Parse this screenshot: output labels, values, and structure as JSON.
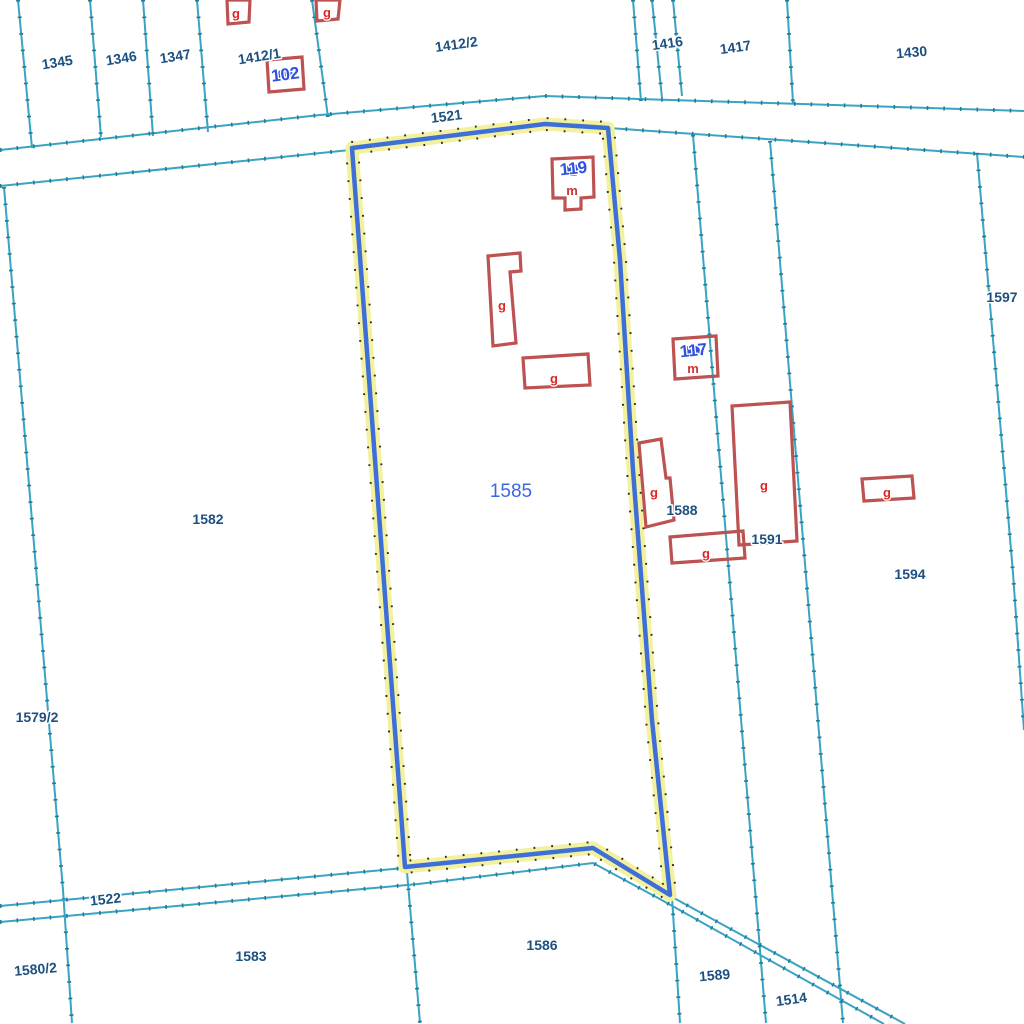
{
  "map": {
    "canvas": {
      "w": 1024,
      "h": 1024,
      "bg": "#ffffff"
    },
    "palette": {
      "boundary": "#3aa3c2",
      "boundary_tick": "#1d7d9c",
      "highlight_halo": "#f3f09e",
      "highlight_dot": "#2a2a2a",
      "highlight_line": "#3e6fd9",
      "building_stroke": "#bd5252",
      "building_label": "#e02525",
      "usage_label": "#cf3333",
      "parcel_label": "#1d5081",
      "selected_label": "#3b66e8",
      "address_label": "#3051e0",
      "address_dot": "#2d49d6",
      "label_halo": "#ffffff"
    },
    "boundary_lines": [
      {
        "id": "road-1521-north-edge",
        "pts": [
          [
            0,
            150
          ],
          [
            320,
            115
          ],
          [
            545,
            96
          ],
          [
            1024,
            111
          ]
        ]
      },
      {
        "id": "road-1521-south-edge-west",
        "pts": [
          [
            0,
            186
          ],
          [
            350,
            150
          ]
        ]
      },
      {
        "id": "road-1521-south-edge-east",
        "pts": [
          [
            609,
            128
          ],
          [
            1024,
            157
          ]
        ]
      },
      {
        "id": "line-left-margin",
        "pts": [
          [
            18,
            0
          ],
          [
            32,
            148
          ]
        ]
      },
      {
        "id": "line-1345-1346",
        "pts": [
          [
            90,
            0
          ],
          [
            101,
            137
          ]
        ]
      },
      {
        "id": "line-1346-1347",
        "pts": [
          [
            143,
            0
          ],
          [
            153,
            136
          ]
        ]
      },
      {
        "id": "line-1347-1412-1",
        "pts": [
          [
            197,
            0
          ],
          [
            208,
            132
          ]
        ]
      },
      {
        "id": "line-1412-1-1412-2",
        "pts": [
          [
            312,
            0
          ],
          [
            328,
            117
          ]
        ]
      },
      {
        "id": "line-1412-2-east",
        "pts": [
          [
            633,
            0
          ],
          [
            641,
            101
          ]
        ]
      },
      {
        "id": "line-1416-west",
        "pts": [
          [
            652,
            0
          ],
          [
            662,
            98
          ]
        ]
      },
      {
        "id": "line-1416-east",
        "pts": [
          [
            673,
            0
          ],
          [
            682,
            96
          ]
        ]
      },
      {
        "id": "line-1417-1430",
        "pts": [
          [
            787,
            0
          ],
          [
            793,
            103
          ]
        ]
      },
      {
        "id": "line-1579-1582",
        "pts": [
          [
            4,
            187
          ],
          [
            63,
            890
          ],
          [
            72,
            1023
          ]
        ]
      },
      {
        "id": "line-1588-1591",
        "pts": [
          [
            693,
            135
          ],
          [
            766,
            1023
          ]
        ]
      },
      {
        "id": "line-1591-1594",
        "pts": [
          [
            770,
            141
          ],
          [
            843,
            1023
          ]
        ]
      },
      {
        "id": "line-1594-1597",
        "pts": [
          [
            977,
            153
          ],
          [
            1013,
            573
          ],
          [
            1024,
            730
          ]
        ]
      },
      {
        "id": "road-1522-north-edge",
        "pts": [
          [
            0,
            906
          ],
          [
            404,
            868
          ]
        ]
      },
      {
        "id": "road-1522-south-edge",
        "pts": [
          [
            0,
            922
          ],
          [
            418,
            884
          ],
          [
            593,
            863
          ],
          [
            658,
            898
          ],
          [
            884,
            1024
          ]
        ]
      },
      {
        "id": "road-1514-north-edge",
        "pts": [
          [
            672,
            897
          ],
          [
            905,
            1024
          ]
        ]
      },
      {
        "id": "line-1583-1586",
        "pts": [
          [
            407,
            872
          ],
          [
            420,
            1023
          ]
        ]
      },
      {
        "id": "line-1586-1589",
        "pts": [
          [
            672,
            897
          ],
          [
            680,
            1023
          ]
        ]
      }
    ],
    "selected_parcel": {
      "number": "1585",
      "outline": [
        [
          352,
          148
        ],
        [
          545,
          124
        ],
        [
          608,
          128
        ],
        [
          620,
          260
        ],
        [
          633,
          470
        ],
        [
          652,
          720
        ],
        [
          670,
          895
        ],
        [
          593,
          848
        ],
        [
          405,
          867
        ]
      ]
    },
    "buildings": [
      {
        "id": "building-g-top-1",
        "pts": [
          [
            227,
            0
          ],
          [
            250,
            0
          ],
          [
            249,
            22
          ],
          [
            228,
            24
          ]
        ],
        "label": {
          "text": "g",
          "x": 236,
          "y": 18
        }
      },
      {
        "id": "building-g-top-2",
        "pts": [
          [
            316,
            0
          ],
          [
            340,
            0
          ],
          [
            338,
            19
          ],
          [
            317,
            21
          ]
        ],
        "label": {
          "text": "g",
          "x": 327,
          "y": 17
        }
      },
      {
        "id": "building-102",
        "pts": [
          [
            267,
            60
          ],
          [
            302,
            57
          ],
          [
            304,
            89
          ],
          [
            269,
            92
          ]
        ],
        "label": null
      },
      {
        "id": "building-119",
        "pts": [
          [
            552,
            159
          ],
          [
            593,
            157
          ],
          [
            594,
            197
          ],
          [
            581,
            198
          ],
          [
            581,
            209
          ],
          [
            565,
            210
          ],
          [
            565,
            198
          ],
          [
            553,
            198
          ]
        ],
        "label": {
          "text": "m",
          "x": 572,
          "y": 195
        }
      },
      {
        "id": "building-g-tall",
        "pts": [
          [
            488,
            256
          ],
          [
            520,
            253
          ],
          [
            521,
            271
          ],
          [
            510,
            272
          ],
          [
            516,
            343
          ],
          [
            493,
            346
          ]
        ],
        "label": {
          "text": "g",
          "x": 502,
          "y": 310
        }
      },
      {
        "id": "building-g-wide-1585",
        "pts": [
          [
            523,
            358
          ],
          [
            588,
            354
          ],
          [
            590,
            385
          ],
          [
            525,
            388
          ]
        ],
        "label": {
          "text": "g",
          "x": 554,
          "y": 383
        }
      },
      {
        "id": "building-117",
        "pts": [
          [
            673,
            339
          ],
          [
            716,
            336
          ],
          [
            718,
            376
          ],
          [
            675,
            379
          ]
        ],
        "label": {
          "text": "m",
          "x": 693,
          "y": 373
        }
      },
      {
        "id": "building-g-1588",
        "pts": [
          [
            639,
            443
          ],
          [
            661,
            439
          ],
          [
            666,
            478
          ],
          [
            670,
            478
          ],
          [
            674,
            520
          ],
          [
            646,
            527
          ]
        ],
        "label": {
          "text": "g",
          "x": 654,
          "y": 497
        }
      },
      {
        "id": "building-g-wide-1588",
        "pts": [
          [
            670,
            537
          ],
          [
            743,
            531
          ],
          [
            745,
            558
          ],
          [
            672,
            563
          ]
        ],
        "label": {
          "text": "g",
          "x": 706,
          "y": 558
        }
      },
      {
        "id": "building-g-1591",
        "pts": [
          [
            732,
            406
          ],
          [
            790,
            402
          ],
          [
            797,
            541
          ],
          [
            739,
            545
          ]
        ],
        "label": {
          "text": "g",
          "x": 764,
          "y": 490
        }
      },
      {
        "id": "building-g-1594",
        "pts": [
          [
            862,
            479
          ],
          [
            912,
            476
          ],
          [
            914,
            498
          ],
          [
            864,
            501
          ]
        ],
        "label": {
          "text": "g",
          "x": 887,
          "y": 497
        }
      }
    ],
    "parcel_labels": [
      {
        "text": "1345",
        "x": 58,
        "y": 67,
        "rot": -9
      },
      {
        "text": "1346",
        "x": 122,
        "y": 63,
        "rot": -9
      },
      {
        "text": "1347",
        "x": 176,
        "y": 61,
        "rot": -9
      },
      {
        "text": "1412/1",
        "x": 260,
        "y": 61,
        "rot": -9
      },
      {
        "text": "1412/2",
        "x": 457,
        "y": 49,
        "rot": -8
      },
      {
        "text": "1416",
        "x": 668,
        "y": 48,
        "rot": -8
      },
      {
        "text": "1417",
        "x": 736,
        "y": 52,
        "rot": -8
      },
      {
        "text": "1430",
        "x": 912,
        "y": 57,
        "rot": -5
      },
      {
        "text": "1521",
        "x": 447,
        "y": 121,
        "rot": -7
      },
      {
        "text": "1597",
        "x": 1002,
        "y": 302,
        "rot": 0
      },
      {
        "text": "1582",
        "x": 208,
        "y": 524,
        "rot": 0
      },
      {
        "text": "1588",
        "x": 682,
        "y": 515,
        "rot": 0
      },
      {
        "text": "1591",
        "x": 767,
        "y": 544,
        "rot": 0
      },
      {
        "text": "1594",
        "x": 910,
        "y": 579,
        "rot": 0
      },
      {
        "text": "1579/2",
        "x": 37,
        "y": 722,
        "rot": 0
      },
      {
        "text": "1522",
        "x": 106,
        "y": 904,
        "rot": -6
      },
      {
        "text": "1583",
        "x": 251,
        "y": 961,
        "rot": 0
      },
      {
        "text": "1586",
        "x": 542,
        "y": 950,
        "rot": 0
      },
      {
        "text": "1580/2",
        "x": 36,
        "y": 974,
        "rot": -5
      },
      {
        "text": "1589",
        "x": 715,
        "y": 980,
        "rot": -5
      },
      {
        "text": "1514",
        "x": 792,
        "y": 1004,
        "rot": -8
      }
    ],
    "selected_label": {
      "text": "1585",
      "x": 511,
      "y": 497
    },
    "address_points": [
      {
        "text": "102",
        "x": 286,
        "y": 80,
        "dot_x": 285,
        "dot_y": 75,
        "rot": -7
      },
      {
        "text": "119",
        "x": 574,
        "y": 174,
        "dot_x": 573,
        "dot_y": 170,
        "rot": -6
      },
      {
        "text": "117",
        "x": 694,
        "y": 356,
        "dot_x": 692,
        "dot_y": 351,
        "rot": -6
      }
    ]
  }
}
